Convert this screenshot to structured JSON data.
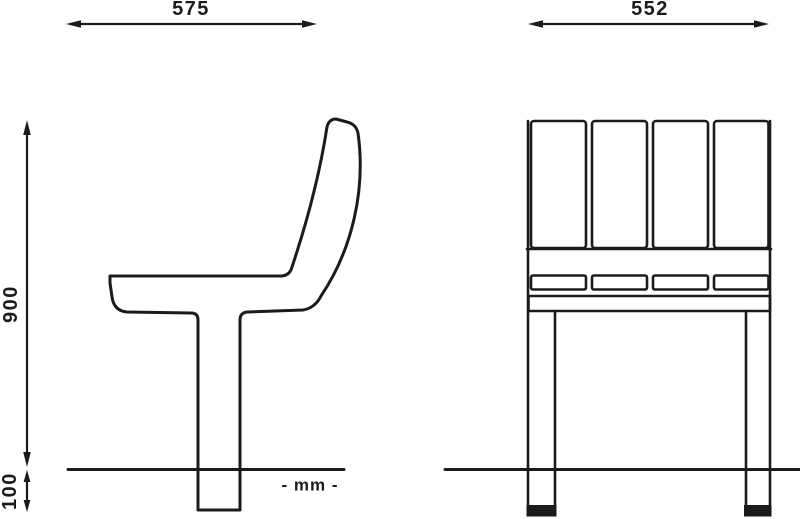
{
  "drawing": {
    "dimensions": {
      "side_view_depth": "575",
      "front_view_width": "552",
      "overall_height": "900",
      "base_height": "100"
    },
    "units_note": "- mm -"
  },
  "colors": {
    "line": "#1b1b1b",
    "background": "#ffffff"
  }
}
